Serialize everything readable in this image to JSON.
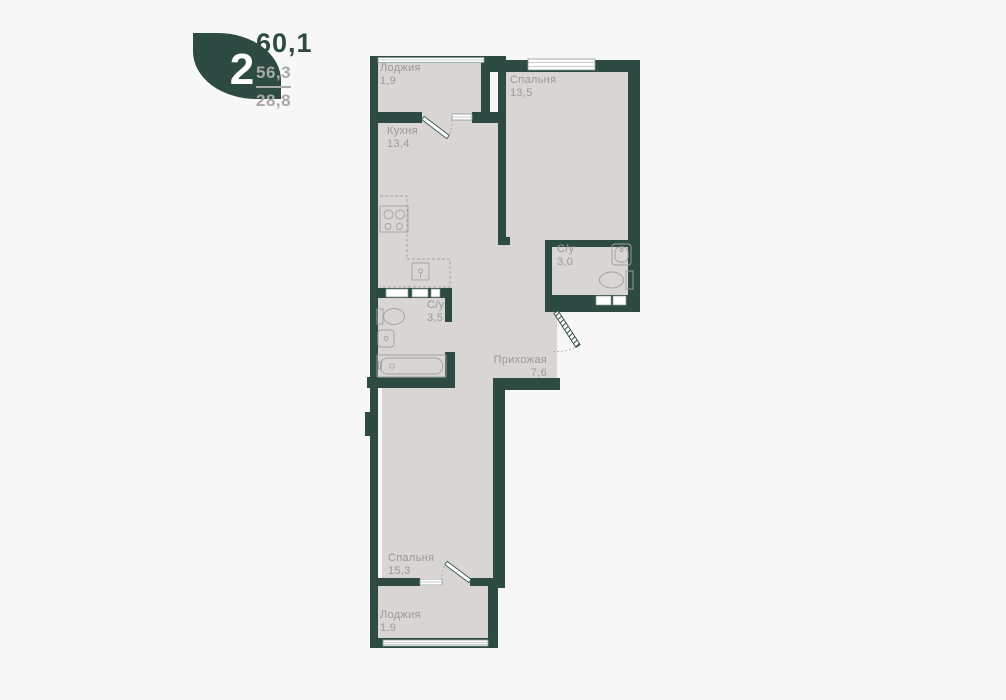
{
  "logo": {
    "room_count": "2",
    "total_area": "60,1",
    "area_top": "56,3",
    "area_bottom": "28,8"
  },
  "plan": {
    "rooms": [
      {
        "id": "loggia-top",
        "name": "Лоджия",
        "area": "1,9"
      },
      {
        "id": "kitchen",
        "name": "Кухня",
        "area": "13,4"
      },
      {
        "id": "bedroom-top",
        "name": "Спальня",
        "area": "13,5"
      },
      {
        "id": "bathroom-small",
        "name": "С/у",
        "area": "3,0"
      },
      {
        "id": "bathroom-large",
        "name": "С/у",
        "area": "3,5"
      },
      {
        "id": "hallway",
        "name": "Прихожая",
        "area": "7,6"
      },
      {
        "id": "bedroom-bottom",
        "name": "Спальня",
        "area": "15,3"
      },
      {
        "id": "loggia-bottom",
        "name": "Лоджия",
        "area": "1,9"
      }
    ]
  },
  "colors": {
    "wall": "#2d4b43",
    "floor": "#d8d5d2",
    "background": "#f7f7f7",
    "label_text": "#9b9b9b",
    "logo_accent": "#2d4b43",
    "logo_muted": "#a9a9a9"
  }
}
